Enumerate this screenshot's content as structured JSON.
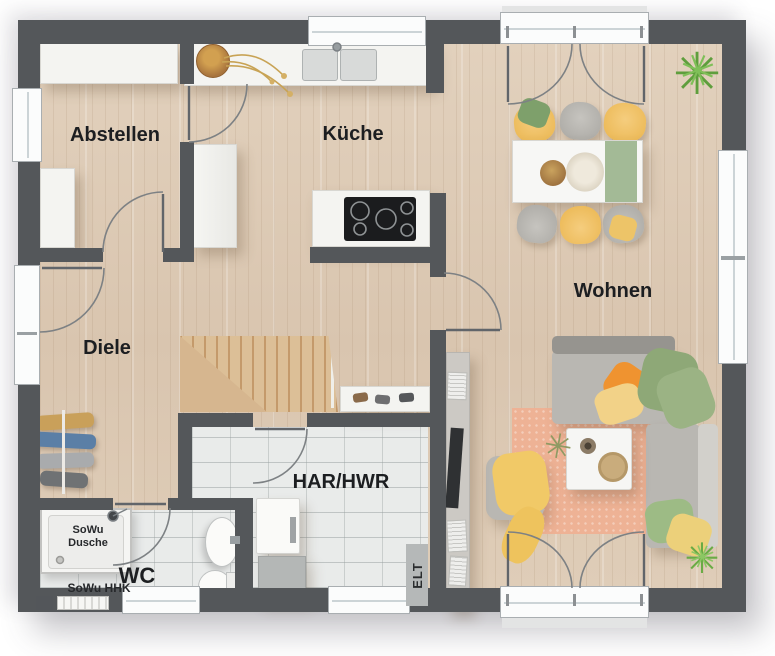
{
  "rooms": {
    "abstellen": {
      "label": "Abstellen"
    },
    "kueche": {
      "label": "Küche"
    },
    "wohnen": {
      "label": "Wohnen"
    },
    "diele": {
      "label": "Diele"
    },
    "wc": {
      "label": "WC"
    },
    "har_hwr": {
      "label": "HAR/HWR"
    }
  },
  "annotations": {
    "sowu_dusche_line1": "SoWu",
    "sowu_dusche_line2": "Dusche",
    "sowu_hhk": "SoWu HHK",
    "elt": "ELT"
  },
  "palette": {
    "wall": "#54575a",
    "wood_floor": "#ddcbb6",
    "tile_floor": "#e9ebea",
    "stairs_wood": "#d5b58e",
    "accent_yellow": "#f0c064",
    "accent_orange": "#ef9330",
    "accent_green": "#8ca577",
    "rug_salmon": "#eeb295",
    "sofa_gray": "#b9b7b2",
    "furniture_white": "#f4f4f1",
    "plant_green": "#5f9e3d",
    "label_text": "#1c1e21"
  }
}
